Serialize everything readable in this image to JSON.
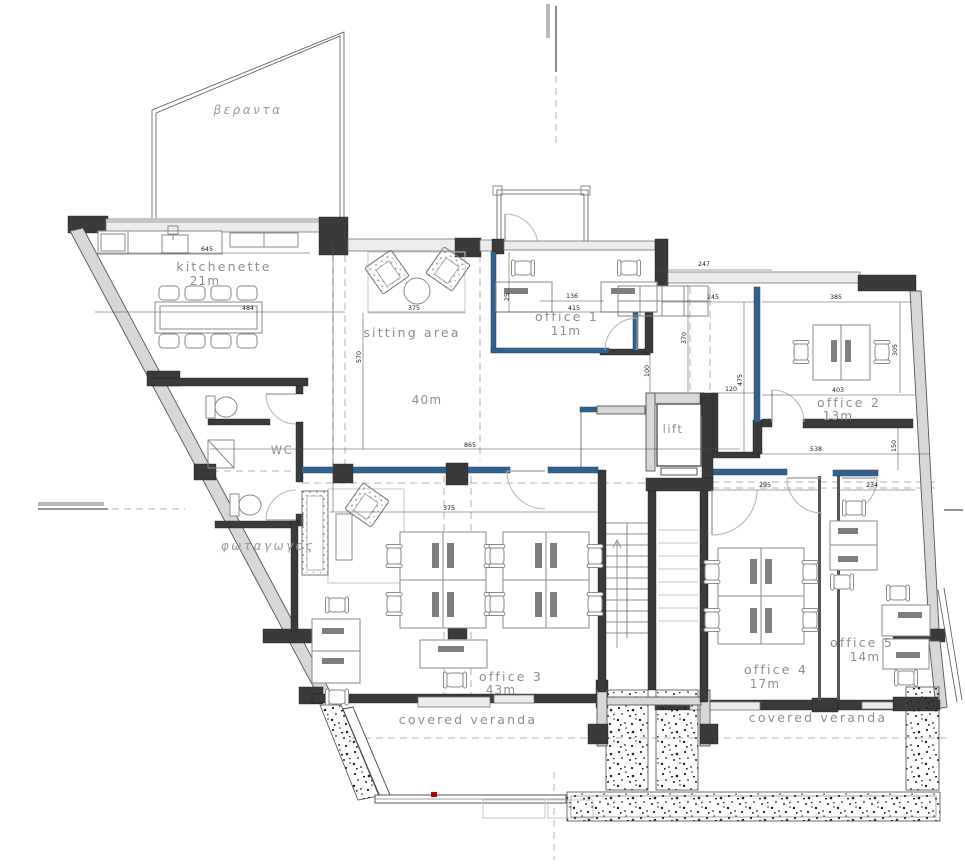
{
  "plan": {
    "type": "architectural-floor-plan",
    "colors": {
      "wall": "#3a3a3a",
      "light_wall": "#d7d7d7",
      "glass_partition": "#35608d",
      "label": "#8e8e8e",
      "dimension_text": "#1a1a1a",
      "accent_red": "#b30000"
    },
    "labels": [
      {
        "id": "veranda",
        "text": "βεραντα",
        "x": 248,
        "y": 114,
        "cls": "greek"
      },
      {
        "id": "kitchenette",
        "text": "kitchenette",
        "x": 224,
        "y": 271,
        "cls": "room"
      },
      {
        "id": "kitchenette-area",
        "text": "21m",
        "x": 205,
        "y": 285,
        "cls": "area"
      },
      {
        "id": "sitting-area",
        "text": "sitting area",
        "x": 412,
        "y": 337,
        "cls": "room"
      },
      {
        "id": "main-area",
        "text": "40m",
        "x": 427,
        "y": 404,
        "cls": "area"
      },
      {
        "id": "office-1",
        "text": "office 1",
        "x": 567,
        "y": 321,
        "cls": "room"
      },
      {
        "id": "office-1-area",
        "text": "11m",
        "x": 566,
        "y": 335,
        "cls": "area"
      },
      {
        "id": "office-2",
        "text": "office 2",
        "x": 849,
        "y": 407,
        "cls": "room"
      },
      {
        "id": "office-2-area",
        "text": "13m",
        "x": 838,
        "y": 420,
        "cls": "area"
      },
      {
        "id": "lift",
        "text": "lift",
        "x": 673,
        "y": 433,
        "cls": "small"
      },
      {
        "id": "wc",
        "text": "WC",
        "x": 282,
        "y": 454,
        "cls": "small"
      },
      {
        "id": "light-well",
        "text": "φωταγωγος",
        "x": 268,
        "y": 550,
        "cls": "greek"
      },
      {
        "id": "office-3",
        "text": "office 3",
        "x": 511,
        "y": 681,
        "cls": "room"
      },
      {
        "id": "office-3-area",
        "text": "43m",
        "x": 501,
        "y": 694,
        "cls": "area"
      },
      {
        "id": "office-4",
        "text": "office 4",
        "x": 776,
        "y": 674,
        "cls": "room"
      },
      {
        "id": "office-4-area",
        "text": "17m",
        "x": 765,
        "y": 688,
        "cls": "area"
      },
      {
        "id": "office-5",
        "text": "office 5",
        "x": 862,
        "y": 647,
        "cls": "room"
      },
      {
        "id": "office-5-area",
        "text": "14m",
        "x": 865,
        "y": 661,
        "cls": "area"
      },
      {
        "id": "covered-veranda-left",
        "text": "covered veranda",
        "x": 468,
        "y": 724,
        "cls": "room"
      },
      {
        "id": "covered-veranda-right",
        "text": "covered veranda",
        "x": 818,
        "y": 722,
        "cls": "room"
      }
    ],
    "dimensions": [
      {
        "text": "645",
        "x": 207,
        "y": 251,
        "r": 0
      },
      {
        "text": "484",
        "x": 248,
        "y": 310,
        "r": 0
      },
      {
        "text": "375",
        "x": 414,
        "y": 310,
        "r": 0
      },
      {
        "text": "415",
        "x": 574,
        "y": 310,
        "r": 0
      },
      {
        "text": "136",
        "x": 572,
        "y": 298,
        "r": 0
      },
      {
        "text": "25",
        "x": 509,
        "y": 297,
        "r": -90
      },
      {
        "text": "865",
        "x": 470,
        "y": 447,
        "r": 0
      },
      {
        "text": "570",
        "x": 361,
        "y": 357,
        "r": -90
      },
      {
        "text": "247",
        "x": 704,
        "y": 266,
        "r": 0
      },
      {
        "text": "245",
        "x": 713,
        "y": 299,
        "r": 0
      },
      {
        "text": "385",
        "x": 836,
        "y": 299,
        "r": 0
      },
      {
        "text": "370",
        "x": 686,
        "y": 338,
        "r": -90
      },
      {
        "text": "100",
        "x": 649,
        "y": 371,
        "r": -90
      },
      {
        "text": "475",
        "x": 742,
        "y": 380,
        "r": -90
      },
      {
        "text": "120",
        "x": 731,
        "y": 391,
        "r": 0
      },
      {
        "text": "403",
        "x": 838,
        "y": 392,
        "r": 0
      },
      {
        "text": "305",
        "x": 897,
        "y": 350,
        "r": -90
      },
      {
        "text": "538",
        "x": 816,
        "y": 451,
        "r": 0
      },
      {
        "text": "150",
        "x": 896,
        "y": 446,
        "r": -90
      },
      {
        "text": "375",
        "x": 449,
        "y": 510,
        "r": 0
      },
      {
        "text": "295",
        "x": 765,
        "y": 487,
        "r": 0
      },
      {
        "text": "234",
        "x": 872,
        "y": 487,
        "r": 0
      }
    ]
  }
}
